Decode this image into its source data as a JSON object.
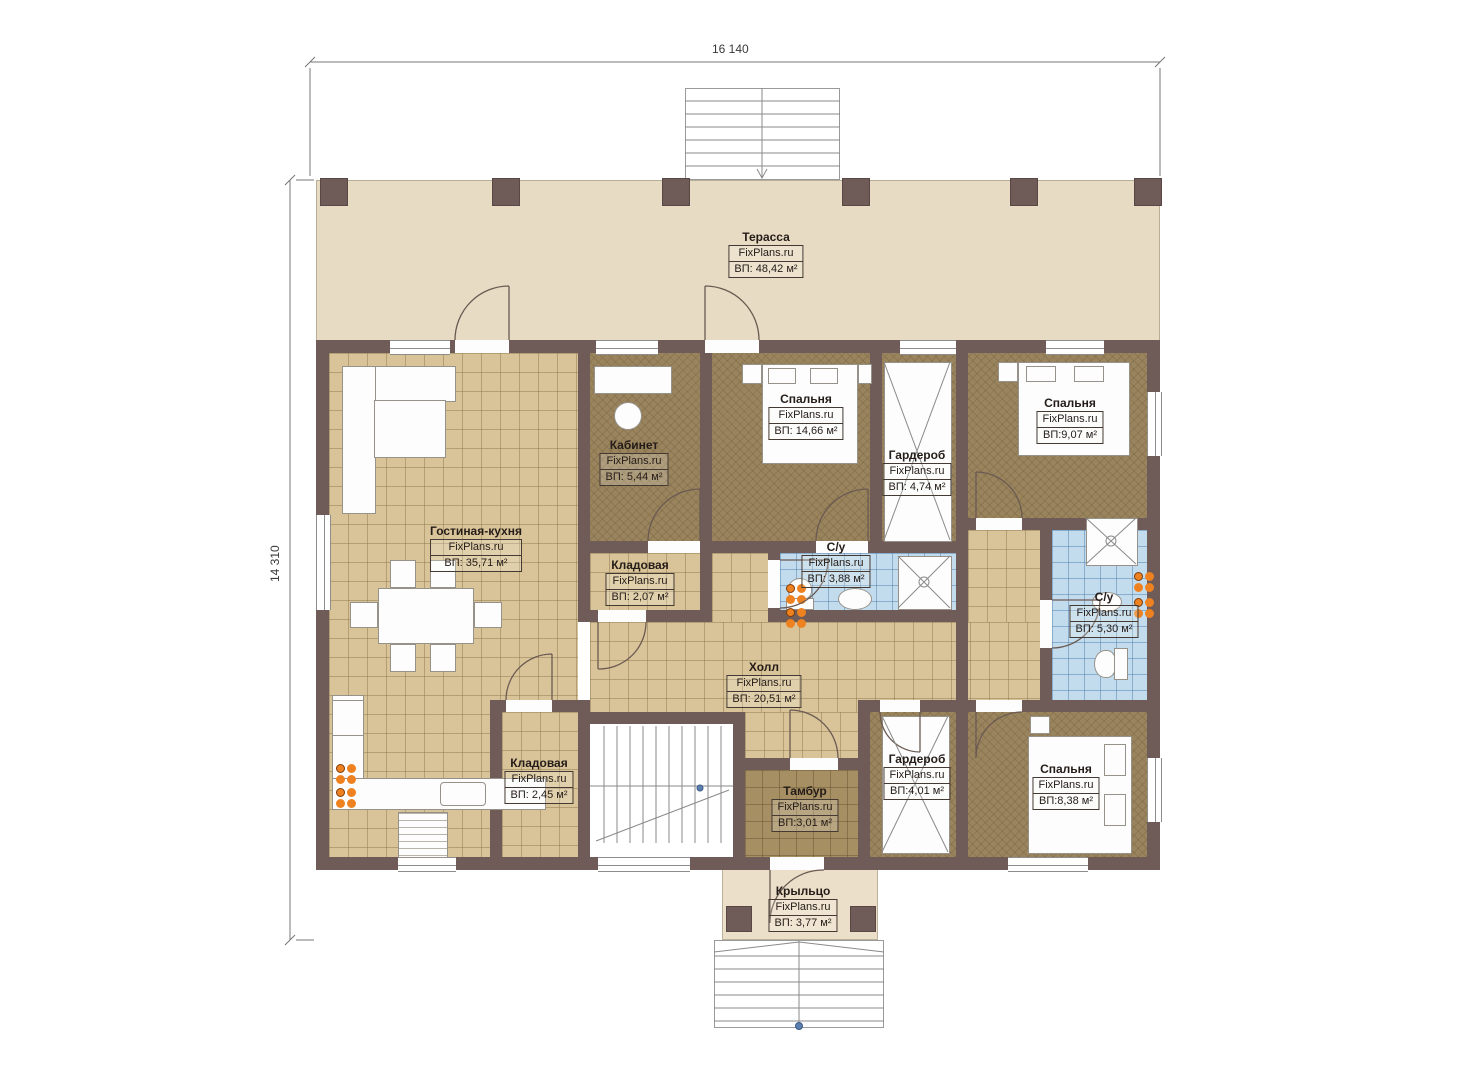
{
  "brand": "FixPlans.ru",
  "dimensions": {
    "width_label": "16 140",
    "height_label": "14 310"
  },
  "rooms": [
    {
      "name": "Терасса",
      "brand": "FixPlans.ru",
      "area": "ВП: 48,42 м²"
    },
    {
      "name": "Гостиная-кухня",
      "brand": "FixPlans.ru",
      "area": "ВП: 35,71 м²"
    },
    {
      "name": "Кабинет",
      "brand": "FixPlans.ru",
      "area": "ВП: 5,44 м²"
    },
    {
      "name": "Спальня",
      "brand": "FixPlans.ru",
      "area": "ВП: 14,66 м²"
    },
    {
      "name": "Гардероб",
      "brand": "FixPlans.ru",
      "area": "ВП: 4,74 м²"
    },
    {
      "name": "Спальня",
      "brand": "FixPlans.ru",
      "area": "ВП:9,07 м²"
    },
    {
      "name": "Кладовая",
      "brand": "FixPlans.ru",
      "area": "ВП: 2,07 м²"
    },
    {
      "name": "С/у",
      "brand": "FixPlans.ru",
      "area": "ВП: 3,88 м²"
    },
    {
      "name": "С/у",
      "brand": "FixPlans.ru",
      "area": "ВП: 5,30 м²"
    },
    {
      "name": "Холл",
      "brand": "FixPlans.ru",
      "area": "ВП: 20,51 м²"
    },
    {
      "name": "Кладовая",
      "brand": "FixPlans.ru",
      "area": "ВП: 2,45 м²"
    },
    {
      "name": "Тамбур",
      "brand": "FixPlans.ru",
      "area": "ВП:3,01 м²"
    },
    {
      "name": "Гардероб",
      "brand": "FixPlans.ru",
      "area": "ВП:4,01 м²"
    },
    {
      "name": "Спальня",
      "brand": "FixPlans.ru",
      "area": "ВП:8,38 м²"
    },
    {
      "name": "Крыльцо",
      "brand": "FixPlans.ru",
      "area": "ВП: 3,77 м²"
    }
  ],
  "colors": {
    "wall": "#6f5b58",
    "terrace_floor": "#e8dbc4",
    "tile_floor": "#d9c499",
    "carpet_floor": "#9a845d",
    "wet_floor": "#c2dcee",
    "accent_orange": "#ef8220",
    "label_text": "#241c18"
  }
}
